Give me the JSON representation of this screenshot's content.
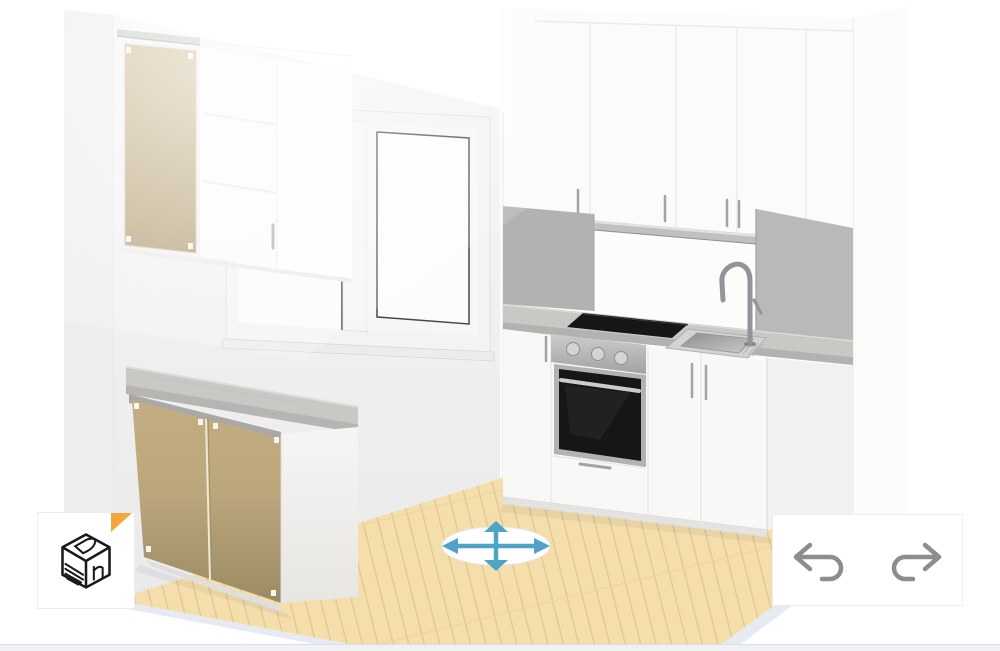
{
  "app": {
    "name": "3d-kitchen-planner",
    "view": "perspective-room-view"
  },
  "ui": {
    "view_button": {
      "icon": "cube-3d-logo-icon",
      "logo_color": "#1a1a1a"
    },
    "history_panel": {
      "undo": {
        "icon": "undo-arrow-icon"
      },
      "redo": {
        "icon": "redo-arrow-icon"
      },
      "icon_color": "#8d8d8d"
    },
    "move_gizmo": {
      "icon": "move-four-way-arrows-icon",
      "arrow_color": "#4fa3c7",
      "disc_color": "#ffffff"
    },
    "bottom_bar_color": "#eff1f4"
  },
  "scene": {
    "colors": {
      "wall_left": "#f2f2f3",
      "wall_right": "#fcfcfb",
      "wall_edge": "#ededee",
      "floor_wood": "#f4dfac",
      "floor_plank_line": "#e3c793",
      "floor_platform_edge": "#e6eaf2",
      "cabinet_white": "#fbfbfa",
      "cabinet_door_tan": "#bca77d",
      "countertop": "#c9c8c5",
      "backsplash": "#b4b2b0",
      "backsplash_right": "#bbb9b7",
      "under_cabinet_rail": "#c0c0be",
      "appliance_steel": "#b7b8b6",
      "appliance_dark": "#161616",
      "sink_steel": "#d3d4d2",
      "marker_orange": "#f2a63b",
      "handle_gray": "#a3a3a1"
    },
    "objects": [
      "window",
      "tall-wall-cabinet-tan",
      "wall-cabinet-white-left",
      "base-cabinet-peninsula-tan",
      "peninsula-countertop",
      "wall-cabinets-right",
      "backsplash-left-panel",
      "backsplash-right-panel",
      "countertop-right",
      "induction-cooktop",
      "built-in-oven",
      "sink",
      "faucet",
      "base-cabinets-right",
      "wood-floor",
      "move-gizmo"
    ]
  }
}
